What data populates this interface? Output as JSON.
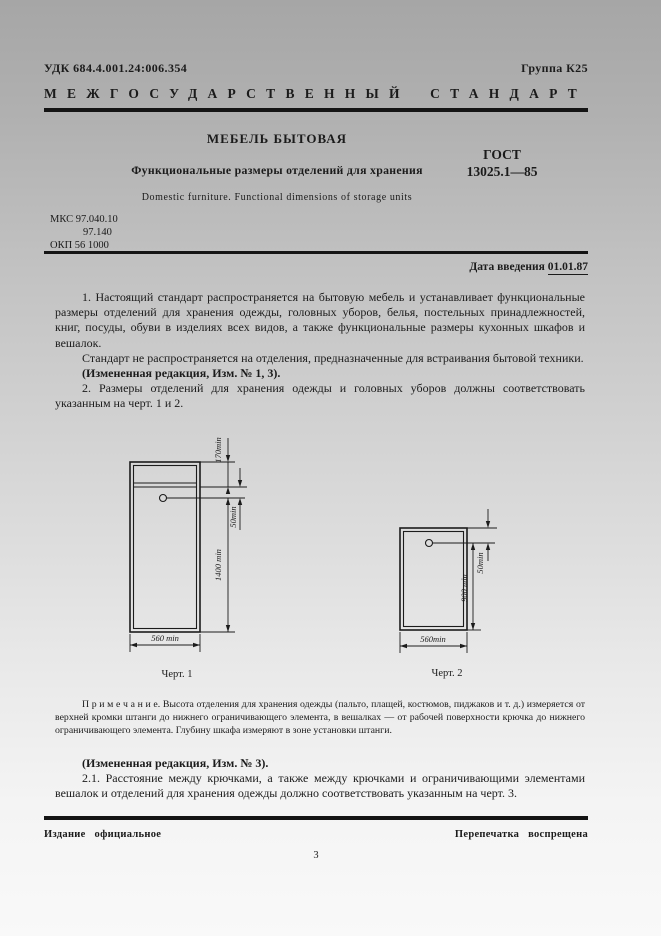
{
  "header": {
    "udk": "УДК 684.4.001.24:006.354",
    "group": "Группа К25",
    "standard_kind": "МЕЖГОСУДАРСТВЕННЫЙ СТАНДАРТ"
  },
  "title_block": {
    "title": "МЕБЕЛЬ БЫТОВАЯ",
    "subtitle": "Функциональные размеры отделений для хранения",
    "title_en": "Domestic furniture. Functional dimensions of storage units",
    "designation_line1": "ГОСТ",
    "designation_line2": "13025.1—85",
    "mks": [
      "МКС 97.040.10",
      "97.140",
      "ОКП 56 1000"
    ],
    "date_label": "Дата введения",
    "date_value": "01.01.87"
  },
  "body": {
    "p1": "1. Настоящий стандарт распространяется на бытовую мебель и устанавливает функциональные размеры отделений для хранения одежды, головных уборов, белья, постельных принадлежностей, книг, посуды, обуви в изделиях всех видов, а также функциональные размеры кухонных шкафов и вешалок.",
    "p2": "Стандарт не распространяется на отделения, предназначенные для встраивания бытовой техники.",
    "amendment1": "(Измененная редакция, Изм. №  1, 3).",
    "p3": "2. Размеры отделений для хранения одежды и головных уборов должны соответствовать указанным на черт. 1 и 2.",
    "note": "П р и м е ч а н и е. Высота отделения для хранения одежды (пальто, плащей, костюмов, пиджаков и т. д.) измеряется от верхней кромки штанги до нижнего ограничивающего элемента, в вешалках — от рабочей поверхности крючка до нижнего ограничивающего элемента. Глубину шкафа измеряют в зоне установки штанги.",
    "amendment2": "(Измененная редакция, Изм.  № 3).",
    "p4": "2.1. Расстояние между крючками, а также между крючками и ограничивающими элементами вешалок и отделений для хранения одежды должно соответствовать указанным на черт. 3."
  },
  "figures": {
    "fig1": {
      "caption": "Черт. 1",
      "dim_top": "170min",
      "dim_rod": "50min",
      "dim_height": "1400 min",
      "dim_width": "560 min"
    },
    "fig2": {
      "caption": "Черт. 2",
      "dim_hook": "50min",
      "dim_height": "900 min",
      "dim_width": "560min"
    }
  },
  "footer": {
    "left": "Издание официальное",
    "right": "Перепечатка воспрещена",
    "page_number": "3"
  },
  "colors": {
    "ink": "#1b1b1b",
    "rule": "#141414"
  }
}
